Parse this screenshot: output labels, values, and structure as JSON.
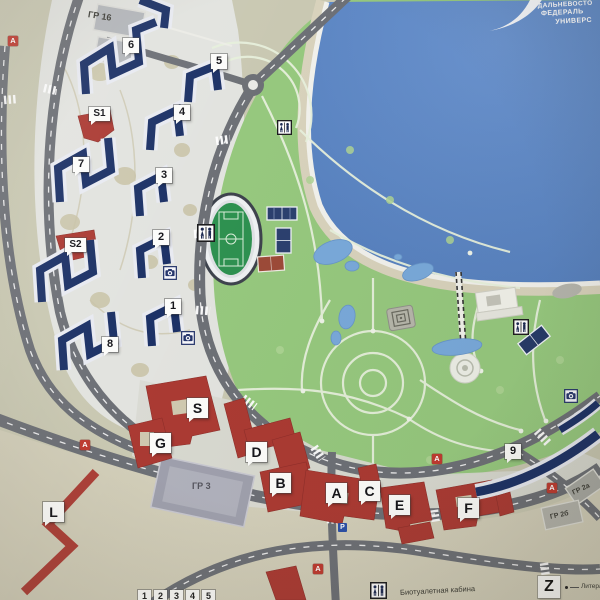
{
  "logo": {
    "line1": "ДАЛЬНЕВОСТО",
    "line2": "ФЕДЕРАЛЬ",
    "line3": "УНИВЕРС"
  },
  "markers": {
    "dorms": [
      "6",
      "5",
      "4",
      "3",
      "7",
      "2",
      "1",
      "8",
      "9"
    ],
    "special": [
      "S1",
      "S2"
    ],
    "academic": [
      "S",
      "G",
      "D",
      "B",
      "A",
      "C",
      "E",
      "F"
    ],
    "line_building": "L"
  },
  "parking_garages": [
    "ГР 16",
    "ГР 3",
    "ГР 2а",
    "ГР 2б"
  ],
  "bus_stop_symbol": "A",
  "parking_symbol": "P",
  "legend": {
    "wc_label": "Биотуалетная кабина",
    "letter_symbol": "Z",
    "letter_label": "Литера у",
    "number_symbols": [
      "1",
      "2",
      "3",
      "4",
      "5"
    ]
  },
  "colors": {
    "water": "#5d87c5",
    "park_green": "#96c87e",
    "road_gray": "#6d7076",
    "dorm_navy": "#1c3166",
    "academic_red": "#ab3a33",
    "land_beige": "#c9c8b2",
    "beach_tan": "#d8d2bc"
  }
}
